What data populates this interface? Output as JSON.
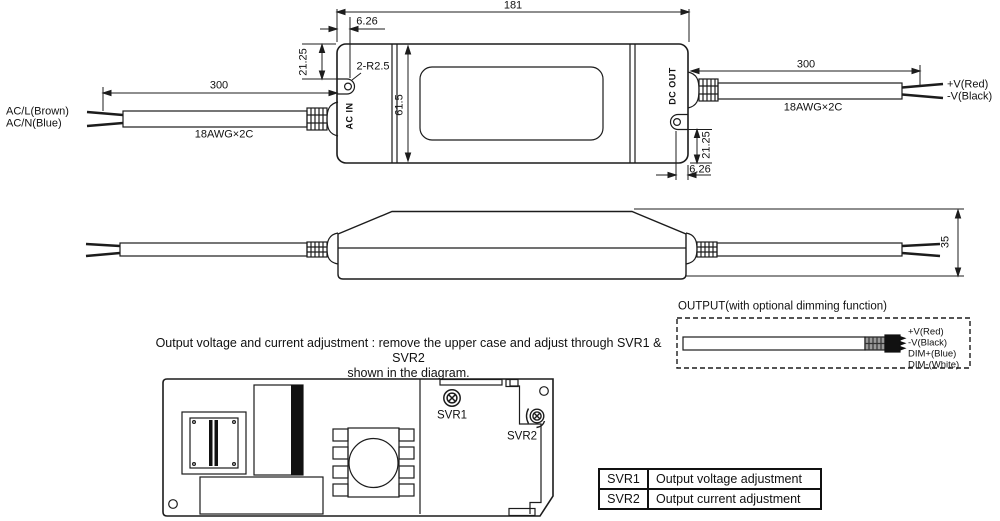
{
  "front_view": {
    "dim_width": "181",
    "dim_notch_left_depth": "6.26",
    "dim_notch_left_offset": "21.25",
    "radius_note": "2-R2.5",
    "dim_body_height": "61.5",
    "ac_in_label": "AC IN",
    "dc_out_label": "DC OUT",
    "dim_notch_right_offset": "21.25",
    "dim_notch_right_depth": "6.26",
    "input_cable": {
      "dim_length": "300",
      "gauge": "18AWG×2C",
      "wire1": "AC/L(Brown)",
      "wire2": "AC/N(Blue)"
    },
    "output_cable": {
      "dim_length": "300",
      "gauge": "18AWG×2C",
      "wire1": "+V(Red)",
      "wire2": "-V(Black)"
    }
  },
  "side_view": {
    "dim_height": "35"
  },
  "output_section": {
    "title": "OUTPUT(with optional dimming function)",
    "wire_labels": [
      "+V(Red)",
      "-V(Black)",
      "DIM+(Blue)",
      "DIM-(White)"
    ]
  },
  "adjustment_note": {
    "line1": "Output voltage and current adjustment : remove the upper case and adjust through SVR1 & SVR2",
    "line2": "shown in the diagram."
  },
  "pcb": {
    "svr1_label": "SVR1",
    "svr2_label": "SVR2"
  },
  "table": {
    "rows": [
      {
        "name": "SVR1",
        "desc": "Output voltage adjustment"
      },
      {
        "name": "SVR2",
        "desc": "Output current adjustment"
      }
    ]
  },
  "colors": {
    "line": "#1c1c1c",
    "background": "#ffffff"
  }
}
